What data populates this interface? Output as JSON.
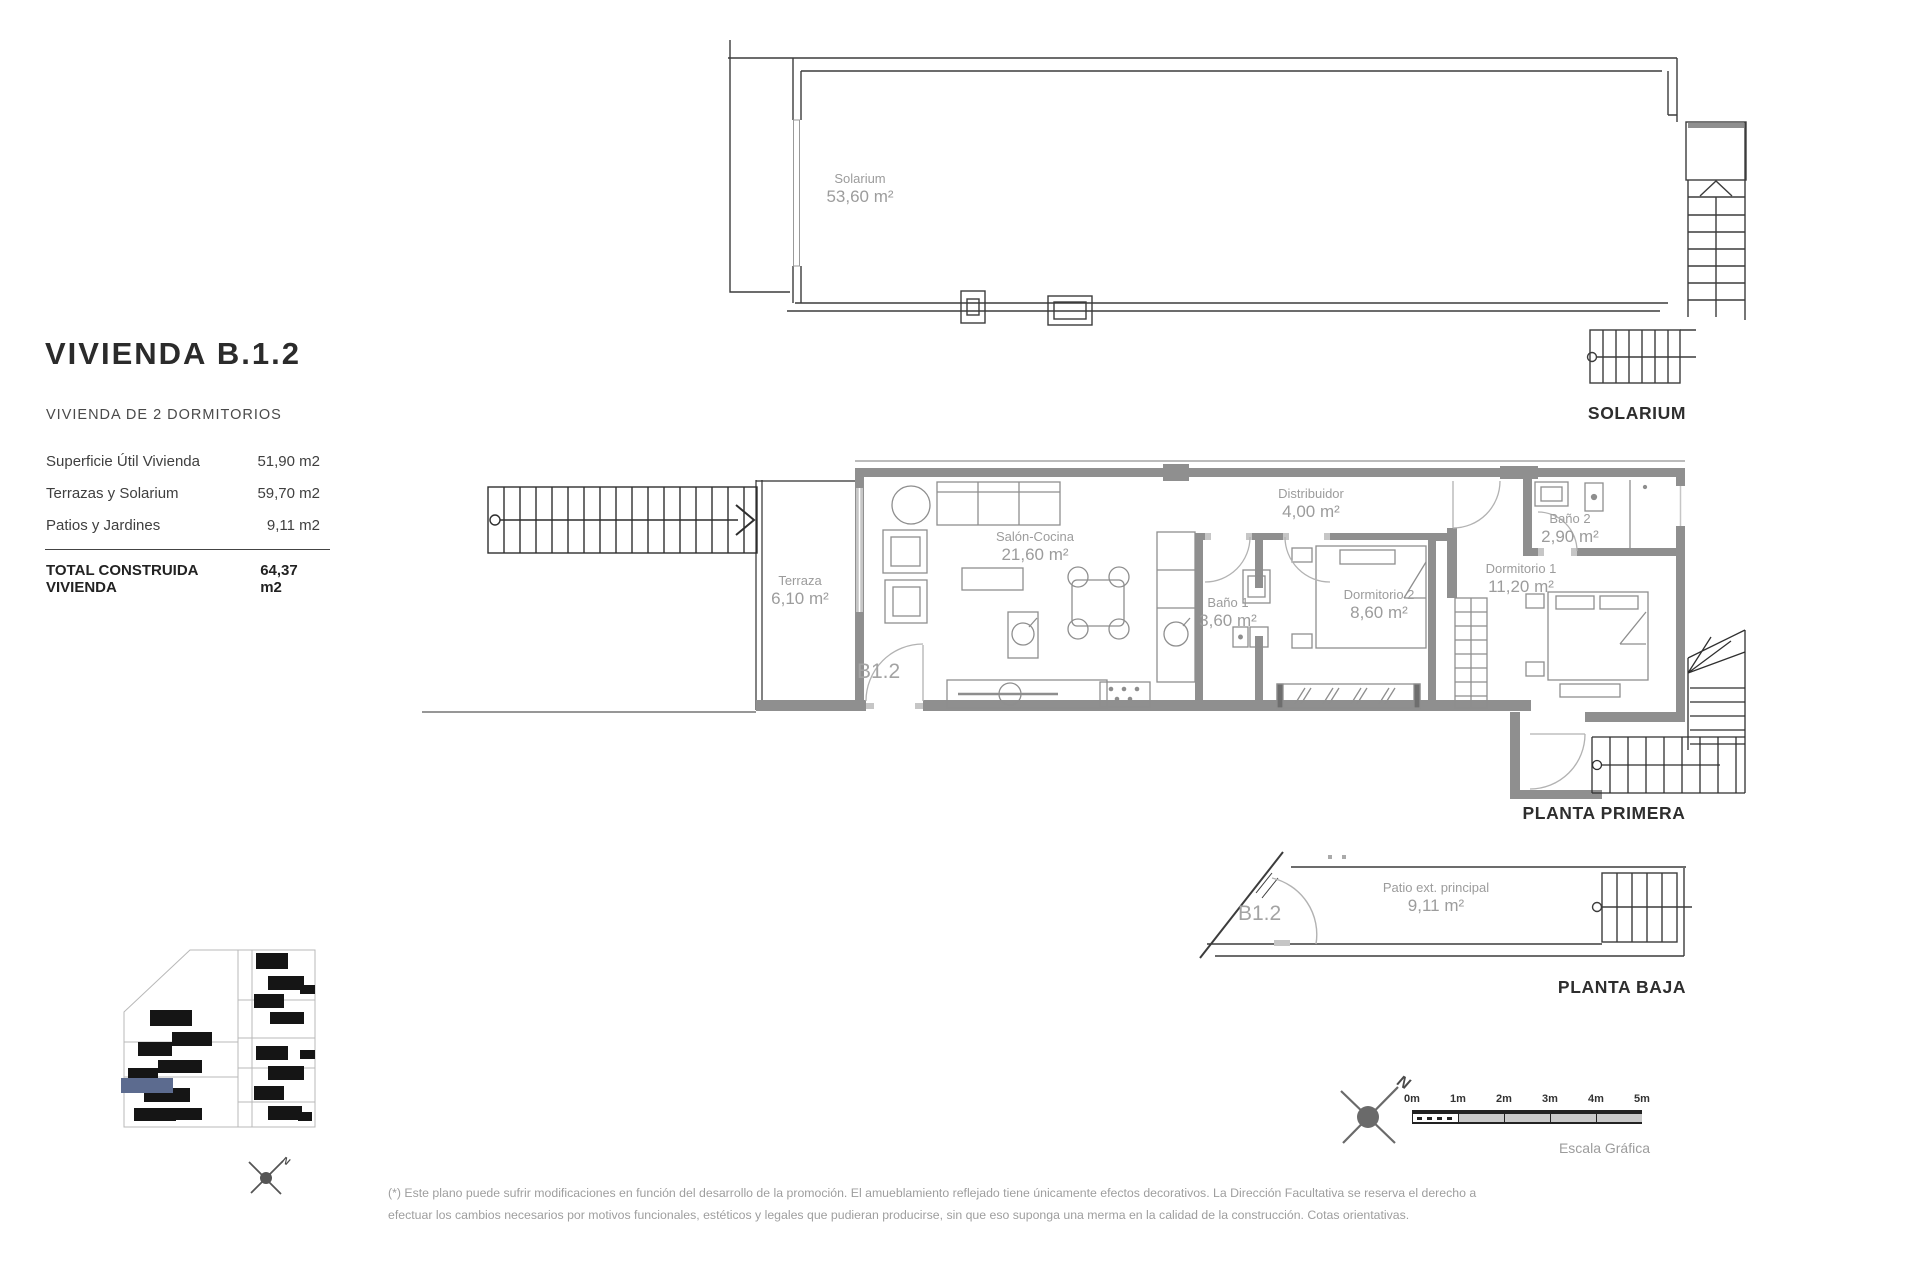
{
  "info_panel": {
    "title": "VIVIENDA B.1.2",
    "subtitle": "VIVIENDA DE 2 DORMITORIOS",
    "rows": [
      {
        "label": "Superficie Útil Vivienda",
        "value": "51,90 m2"
      },
      {
        "label": "Terrazas y Solarium",
        "value": "59,70 m2"
      },
      {
        "label": "Patios y Jardines",
        "value": "9,11 m2"
      }
    ],
    "total": {
      "label": "TOTAL CONSTRUIDA VIVIENDA",
      "value": "64,37 m2"
    }
  },
  "plans": {
    "solarium": {
      "heading": "SOLARIUM",
      "room": {
        "name": "Solarium",
        "area": "53,60 m²"
      }
    },
    "planta_primera": {
      "heading": "PLANTA PRIMERA",
      "unit_label": "B1.2",
      "rooms": [
        {
          "name": "Terraza",
          "area": "6,10 m²"
        },
        {
          "name": "Salón-Cocina",
          "area": "21,60 m²"
        },
        {
          "name": "Distribuidor",
          "area": "4,00 m²"
        },
        {
          "name": "Baño 1",
          "area": "3,60 m²"
        },
        {
          "name": "Dormitorio 2",
          "area": "8,60 m²"
        },
        {
          "name": "Baño 2",
          "area": "2,90 m²"
        },
        {
          "name": "Dormitorio 1",
          "area": "11,20 m²"
        }
      ]
    },
    "planta_baja": {
      "heading": "PLANTA BAJA",
      "unit_label": "B1.2",
      "room": {
        "name": "Patio ext. principal",
        "area": "9,11 m²"
      }
    }
  },
  "compass": {
    "north_label": "N"
  },
  "scale_bar": {
    "ticks": [
      "0m",
      "1m",
      "2m",
      "3m",
      "4m",
      "5m"
    ],
    "caption": "Escala Gráfica"
  },
  "footnote": {
    "line1": "(*) Este plano puede sufrir modificaciones en función del desarrollo de la promoción. El amueblamiento reflejado tiene únicamente efectos decorativos. La Dirección Facultativa se reserva el derecho a",
    "line2": "efectuar los cambios necesarios por motivos funcionales, estéticos y legales que pudieran producirse, sin que eso suponga una merma en la calidad de la construcción. Cotas orientativas."
  },
  "colors": {
    "wall_gray": "#8f8f8f",
    "line_dark": "#3c3c3c",
    "label_gray": "#9c9c9c",
    "heading_dark": "#2e2e2e",
    "highlight_unit_blue": "#5c6b8f"
  }
}
